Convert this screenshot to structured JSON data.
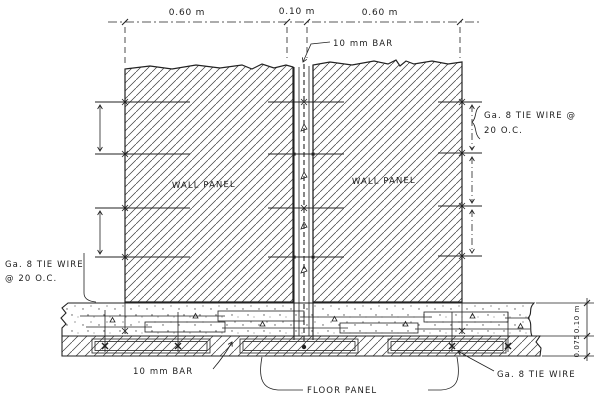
{
  "dims": {
    "top": [
      "0.60 m",
      "0.10 m",
      "0.60 m"
    ],
    "floor": [
      "0.10 m",
      "0.075"
    ]
  },
  "labels": {
    "bar_top": "10 mm BAR",
    "wall_panel_left": "WALL PANEL",
    "wall_panel_right": "WALL PANEL",
    "tie_right_line1": "Ga. 8 TIE WIRE @",
    "tie_right_line2": "20 O.C.",
    "tie_left_line1": "Ga. 8 TIE WIRE",
    "tie_left_line2": "@ 20 O.C.",
    "bar_bottom": "10 mm BAR",
    "floor_panel": "FLOOR PANEL",
    "tie_bottom_right": "Ga. 8 TIE WIRE"
  },
  "colors": {
    "ink": "#222222",
    "paper": "#ffffff"
  }
}
